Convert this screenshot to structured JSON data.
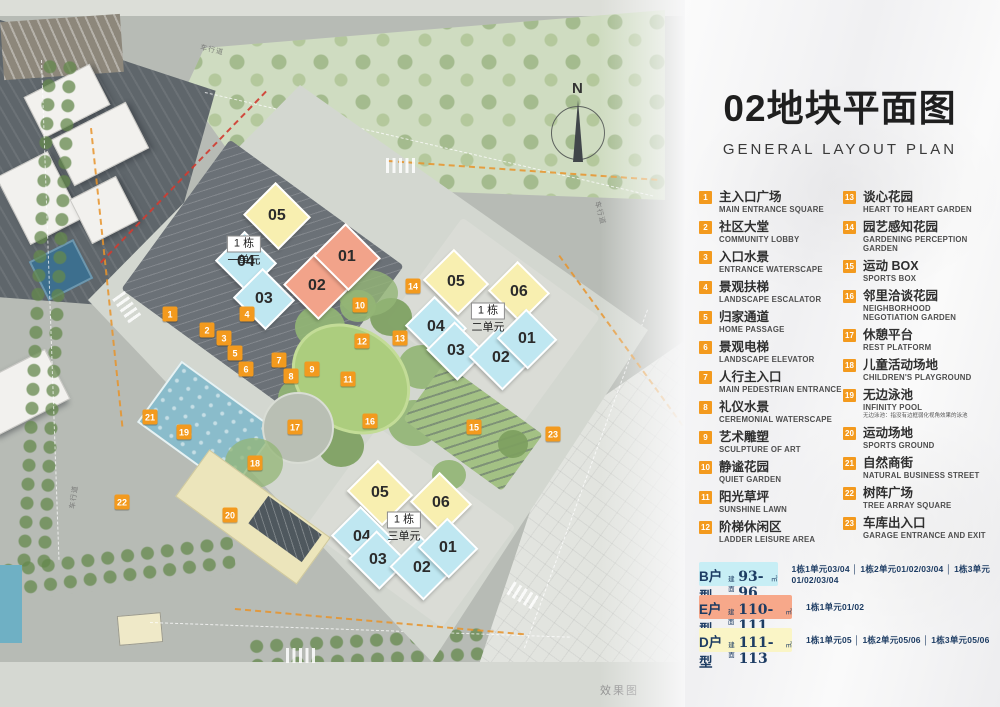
{
  "title": {
    "zh": "02地块平面图",
    "en": "GENERAL LAYOUT PLAN"
  },
  "colors": {
    "accent_orange": "#F39A1E",
    "building_yellow": "#F8EFB0",
    "building_cyan": "#BFE7F1",
    "building_salmon": "#F2A38A",
    "badge_b": "#C7EEF5",
    "badge_e": "#F7A88A",
    "badge_d": "#FAF5C6",
    "badge_text": "#1D3C63"
  },
  "legend": {
    "items": [
      {
        "num": "1",
        "zh": "主入口广场",
        "en": "MAIN ENTRANCE SQUARE"
      },
      {
        "num": "2",
        "zh": "社区大堂",
        "en": "COMMUNITY LOBBY"
      },
      {
        "num": "3",
        "zh": "入口水景",
        "en": "ENTRANCE WATERSCAPE"
      },
      {
        "num": "4",
        "zh": "景观扶梯",
        "en": "LANDSCAPE ESCALATOR"
      },
      {
        "num": "5",
        "zh": "归家通道",
        "en": "HOME PASSAGE"
      },
      {
        "num": "6",
        "zh": "景观电梯",
        "en": "LANDSCAPE ELEVATOR"
      },
      {
        "num": "7",
        "zh": "人行主入口",
        "en": "MAIN PEDESTRIAN ENTRANCE"
      },
      {
        "num": "8",
        "zh": "礼仪水景",
        "en": "CEREMONIAL WATERSCAPE"
      },
      {
        "num": "9",
        "zh": "艺术雕塑",
        "en": "SCULPTURE OF ART"
      },
      {
        "num": "10",
        "zh": "静谧花园",
        "en": "QUIET GARDEN"
      },
      {
        "num": "11",
        "zh": "阳光草坪",
        "en": "SUNSHINE LAWN"
      },
      {
        "num": "12",
        "zh": "阶梯休闲区",
        "en": "LADDER LEISURE AREA"
      },
      {
        "num": "13",
        "zh": "谈心花园",
        "en": "HEART TO HEART GARDEN"
      },
      {
        "num": "14",
        "zh": "园艺感知花园",
        "en": "GARDENING PERCEPTION\nGARDEN"
      },
      {
        "num": "15",
        "zh": "运动 BOX",
        "en": "SPORTS BOX"
      },
      {
        "num": "16",
        "zh": "邻里洽谈花园",
        "en": "NEIGHBORHOOD\nNEGOTIATION GARDEN"
      },
      {
        "num": "17",
        "zh": "休憩平台",
        "en": "REST PLATFORM"
      },
      {
        "num": "18",
        "zh": "儿童活动场地",
        "en": "CHILDREN'S PLAYGROUND"
      },
      {
        "num": "19",
        "zh": "无边泳池",
        "en": "INFINITY POOL",
        "note": "无边泳池：指没有边框弱化视角效果的泳池"
      },
      {
        "num": "20",
        "zh": "运动场地",
        "en": "SPORTS GROUND"
      },
      {
        "num": "21",
        "zh": "自然商街",
        "en": "NATURAL BUSINESS STREET"
      },
      {
        "num": "22",
        "zh": "树阵广场",
        "en": "TREE ARRAY SQUARE"
      },
      {
        "num": "23",
        "zh": "车库出入口",
        "en": "GARAGE ENTRANCE AND EXIT"
      }
    ]
  },
  "unit_types": {
    "rows": [
      {
        "name": "B户型",
        "prefix": "建面",
        "range": "93-96",
        "unit": "㎡",
        "bg": "#C7EEF5",
        "assignments": "1栋1单元03/04 │ 1栋2单元01/02/03/04 │ 1栋3单元01/02/03/04"
      },
      {
        "name": "E户型",
        "prefix": "建面",
        "range": "110-111",
        "unit": "㎡",
        "bg": "#F7A88A",
        "assignments": "1栋1单元01/02"
      },
      {
        "name": "D户型",
        "prefix": "建面",
        "range": "111-113",
        "unit": "㎡",
        "bg": "#FAF5C6",
        "assignments": "1栋1单元05 │ 1栋2单元05/06 │ 1栋3单元05/06"
      }
    ]
  },
  "map": {
    "compass": "N",
    "caption": "效果图",
    "road_label": "车行道",
    "clusters": [
      {
        "l1": "1 栋",
        "l2": "一单元",
        "x": 244,
        "y": 250
      },
      {
        "l1": "1 栋",
        "l2": "二单元",
        "x": 488,
        "y": 317
      },
      {
        "l1": "1 栋",
        "l2": "三单元",
        "x": 404,
        "y": 526
      }
    ],
    "buildings": [
      {
        "n": "05",
        "c": "yellow",
        "x": 277,
        "y": 216,
        "w": 50,
        "h": 46
      },
      {
        "n": "04",
        "c": "cyan",
        "x": 246,
        "y": 262,
        "w": 46,
        "h": 42
      },
      {
        "n": "03",
        "c": "cyan",
        "x": 264,
        "y": 299,
        "w": 46,
        "h": 42
      },
      {
        "n": "02",
        "c": "salmon",
        "x": 317,
        "y": 286,
        "w": 50,
        "h": 46
      },
      {
        "n": "01",
        "c": "salmon",
        "x": 347,
        "y": 257,
        "w": 50,
        "h": 46
      },
      {
        "n": "05",
        "c": "yellow",
        "x": 456,
        "y": 282,
        "w": 50,
        "h": 44
      },
      {
        "n": "06",
        "c": "yellow",
        "x": 519,
        "y": 292,
        "w": 46,
        "h": 42
      },
      {
        "n": "04",
        "c": "cyan",
        "x": 436,
        "y": 327,
        "w": 46,
        "h": 42
      },
      {
        "n": "03",
        "c": "cyan",
        "x": 456,
        "y": 351,
        "w": 44,
        "h": 40
      },
      {
        "n": "02",
        "c": "cyan",
        "x": 501,
        "y": 358,
        "w": 48,
        "h": 44
      },
      {
        "n": "01",
        "c": "cyan",
        "x": 527,
        "y": 339,
        "w": 44,
        "h": 42
      },
      {
        "n": "05",
        "c": "yellow",
        "x": 380,
        "y": 493,
        "w": 50,
        "h": 44
      },
      {
        "n": "06",
        "c": "yellow",
        "x": 441,
        "y": 503,
        "w": 46,
        "h": 42
      },
      {
        "n": "04",
        "c": "cyan",
        "x": 362,
        "y": 537,
        "w": 46,
        "h": 42
      },
      {
        "n": "03",
        "c": "cyan",
        "x": 378,
        "y": 560,
        "w": 44,
        "h": 40
      },
      {
        "n": "02",
        "c": "cyan",
        "x": 422,
        "y": 568,
        "w": 48,
        "h": 44
      },
      {
        "n": "01",
        "c": "cyan",
        "x": 448,
        "y": 548,
        "w": 44,
        "h": 42
      }
    ],
    "markers": [
      {
        "n": "1",
        "x": 170,
        "y": 314
      },
      {
        "n": "2",
        "x": 207,
        "y": 330
      },
      {
        "n": "3",
        "x": 224,
        "y": 338
      },
      {
        "n": "4",
        "x": 247,
        "y": 314
      },
      {
        "n": "5",
        "x": 235,
        "y": 353
      },
      {
        "n": "6",
        "x": 246,
        "y": 369
      },
      {
        "n": "7",
        "x": 279,
        "y": 360
      },
      {
        "n": "8",
        "x": 291,
        "y": 376
      },
      {
        "n": "9",
        "x": 312,
        "y": 369
      },
      {
        "n": "10",
        "x": 360,
        "y": 305
      },
      {
        "n": "11",
        "x": 348,
        "y": 379
      },
      {
        "n": "12",
        "x": 362,
        "y": 341
      },
      {
        "n": "13",
        "x": 400,
        "y": 338
      },
      {
        "n": "14",
        "x": 413,
        "y": 286
      },
      {
        "n": "15",
        "x": 474,
        "y": 427
      },
      {
        "n": "16",
        "x": 370,
        "y": 421
      },
      {
        "n": "17",
        "x": 295,
        "y": 427
      },
      {
        "n": "18",
        "x": 255,
        "y": 463
      },
      {
        "n": "19",
        "x": 184,
        "y": 432
      },
      {
        "n": "20",
        "x": 230,
        "y": 515
      },
      {
        "n": "21",
        "x": 150,
        "y": 417
      },
      {
        "n": "22",
        "x": 122,
        "y": 502
      },
      {
        "n": "23",
        "x": 553,
        "y": 434
      }
    ]
  }
}
